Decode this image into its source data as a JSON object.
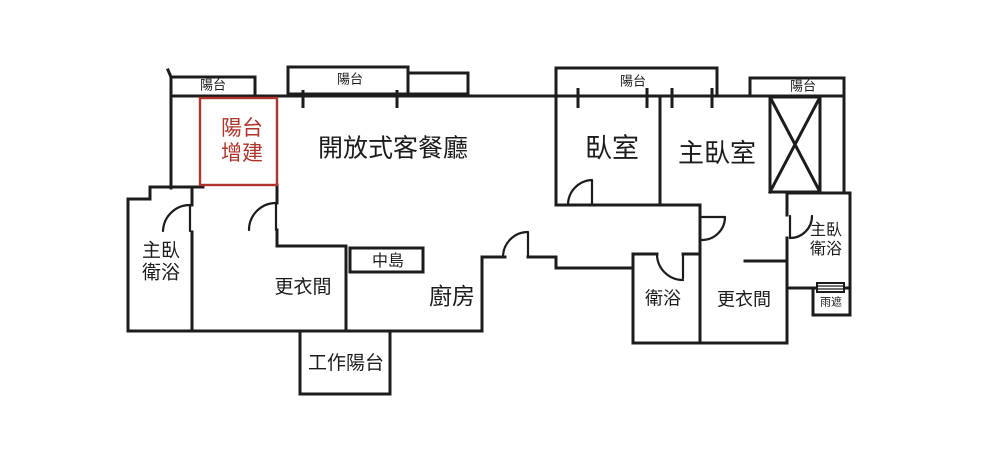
{
  "document": {
    "type": "apartment floor plan drawing",
    "style": "hand-drawn black line floor plan with red annotated balcony addition"
  },
  "colors": {
    "background": "#ffffff",
    "ink": "#1c1c1c",
    "annotation_red": "#ae352b"
  },
  "labels": {
    "balcony_top_left": "陽台",
    "balcony_living": "陽台",
    "balcony_bedrooms": "陽台",
    "balcony_top_right": "陽台",
    "balcony_addition_line1": "陽台",
    "balcony_addition_line2": "增建",
    "living_dining": "開放式客餐廳",
    "bedroom": "臥室",
    "master_bedroom": "主臥室",
    "master_bath_left_line1": "主臥",
    "master_bath_left_line2": "衛浴",
    "walkin_closet_left": "更衣間",
    "kitchen_island": "中島",
    "kitchen": "廚房",
    "work_balcony": "工作陽台",
    "bathroom": "衛浴",
    "walkin_closet_right": "更衣間",
    "master_bath_right_line1": "主臥",
    "master_bath_right_line2": "衛浴",
    "rain_canopy": "雨遮"
  }
}
